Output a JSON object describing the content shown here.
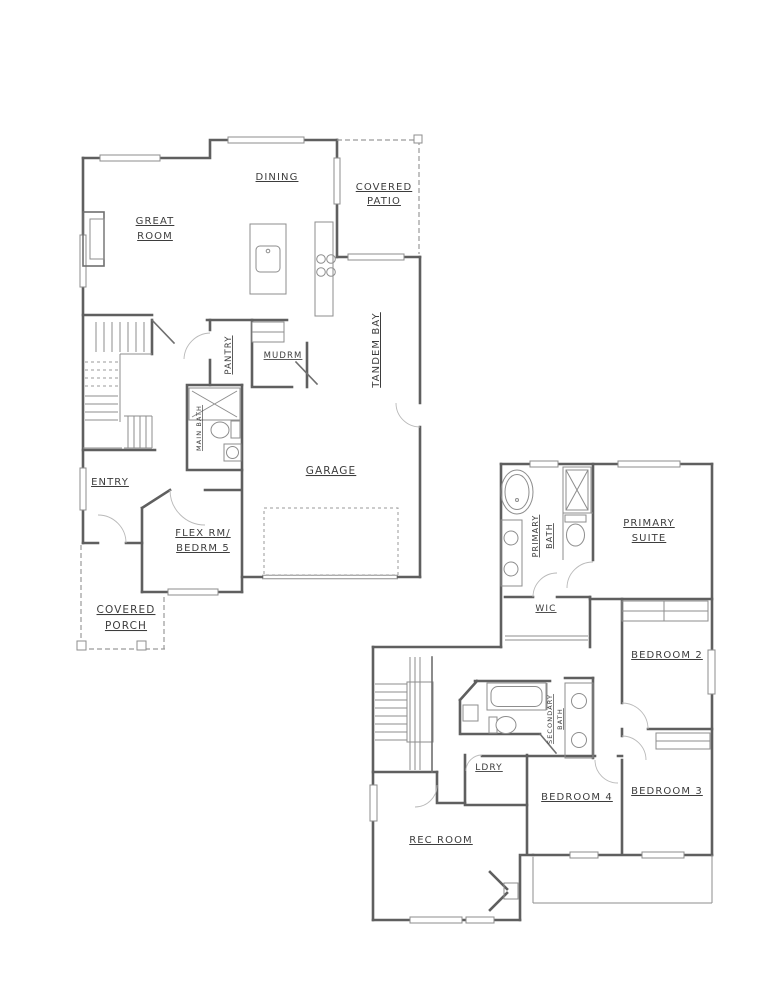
{
  "drawing": {
    "type": "two-story residential floor plan, black-line architectural drawing on white",
    "background": "#ffffff",
    "wall_color": "#5f5f5f",
    "detail_color": "#8d8d8d",
    "dashed_color": "#9a9a9a",
    "label_color": "#3d3d3d"
  },
  "floor1": {
    "labels": {
      "great_room": [
        "GREAT",
        "ROOM"
      ],
      "dining": [
        "DINING"
      ],
      "covered_patio": [
        "COVERED",
        "PATIO"
      ],
      "tandem_bay": [
        "TANDEM BAY"
      ],
      "pantry": [
        "PANTRY"
      ],
      "mudrm": [
        "MUDRM"
      ],
      "main_bath": [
        "MAIN BATH"
      ],
      "garage": [
        "GARAGE"
      ],
      "entry": [
        "ENTRY"
      ],
      "flex_room": [
        "FLEX RM/",
        "BEDRM 5"
      ],
      "covered_porch": [
        "COVERED",
        "PORCH"
      ]
    },
    "fixtures": [
      "kitchen-island-sink",
      "range-cooktop",
      "mudroom-bench",
      "shower",
      "toilet",
      "vanity-sink",
      "staircase",
      "media-niche",
      "garage-parking-outline",
      "porch-posts"
    ]
  },
  "floor2": {
    "labels": {
      "primary_bath": [
        "PRIMARY",
        "BATH"
      ],
      "primary_suite": [
        "PRIMARY",
        "SUITE"
      ],
      "wic": [
        "WIC"
      ],
      "bedroom2": [
        "BEDROOM 2"
      ],
      "secondary_bath": [
        "SECONDARY",
        "BATH"
      ],
      "ldry": [
        "LDRY"
      ],
      "bedroom4": [
        "BEDROOM 4"
      ],
      "bedroom3": [
        "BEDROOM 3"
      ],
      "rec_room": [
        "REC ROOM"
      ]
    },
    "fixtures": [
      "freestanding-tub",
      "shower",
      "toilet",
      "double-vanity",
      "closet-shelves",
      "secondary-tub",
      "secondary-toilet",
      "secondary-double-vanity",
      "staircase",
      "corner-fireplace"
    ]
  }
}
